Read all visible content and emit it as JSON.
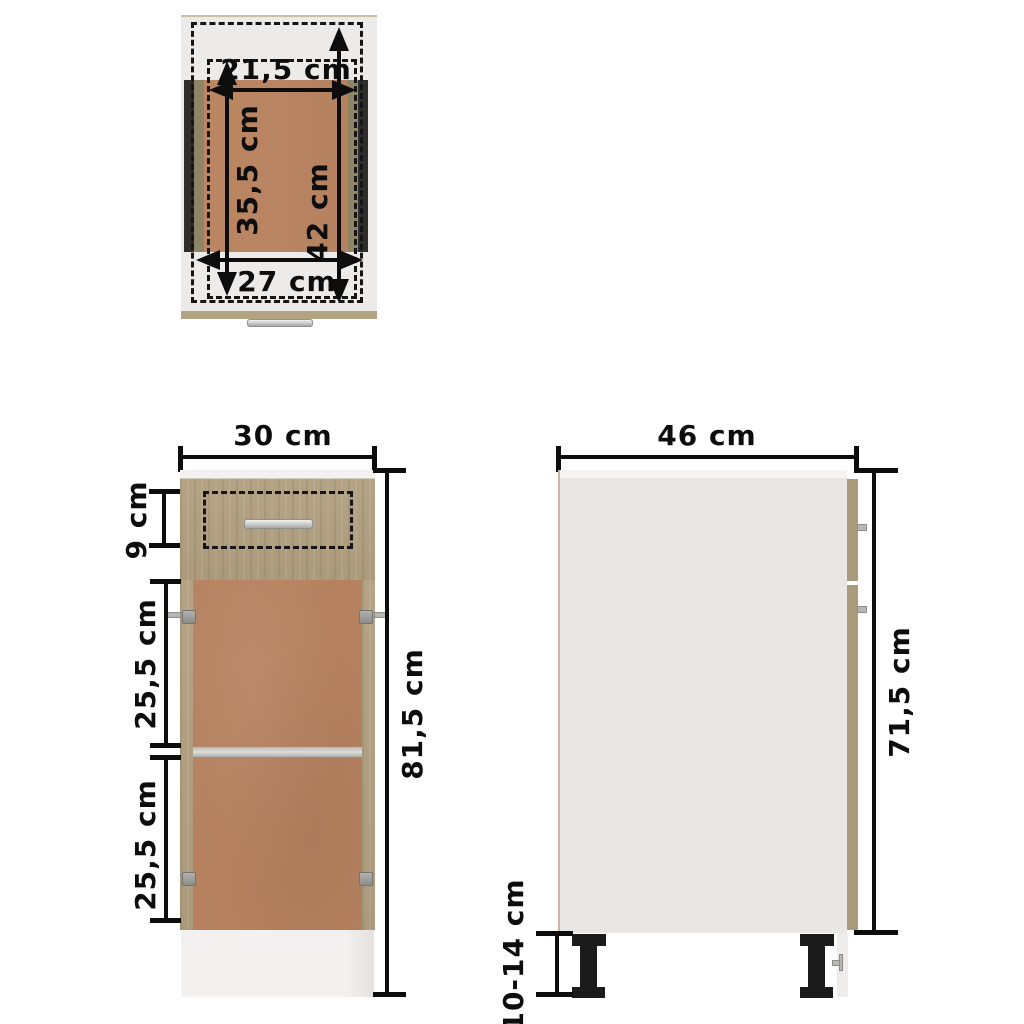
{
  "diagram": {
    "title": "Base cabinet with drawer – dimension diagram",
    "unit": "cm"
  },
  "colors": {
    "oak_wood": "#b1a080",
    "hardboard_brown": "#b5815f",
    "panel_gray": "#e9e7e5",
    "edge_tan": "#a89c7d",
    "dimension_black": "#0d0d0d",
    "plinth_white": "#f1efed",
    "leg_black": "#1b1b1b"
  },
  "top_view": {
    "name": "top view",
    "dims": {
      "drawer_inner_width": "21,5 cm",
      "drawer_inner_depth": "35,5 cm",
      "top_depth": "42 cm",
      "top_width": "27 cm"
    }
  },
  "front_view": {
    "name": "front view",
    "dims": {
      "width": "30 cm",
      "drawer_front_height": "9 cm",
      "upper_compartment": "25,5 cm",
      "lower_compartment": "25,5 cm",
      "total_height": "81,5 cm"
    }
  },
  "side_view": {
    "name": "side view",
    "dims": {
      "depth": "46 cm",
      "body_height": "71,5 cm",
      "legs_height": "10-14 cm"
    }
  }
}
